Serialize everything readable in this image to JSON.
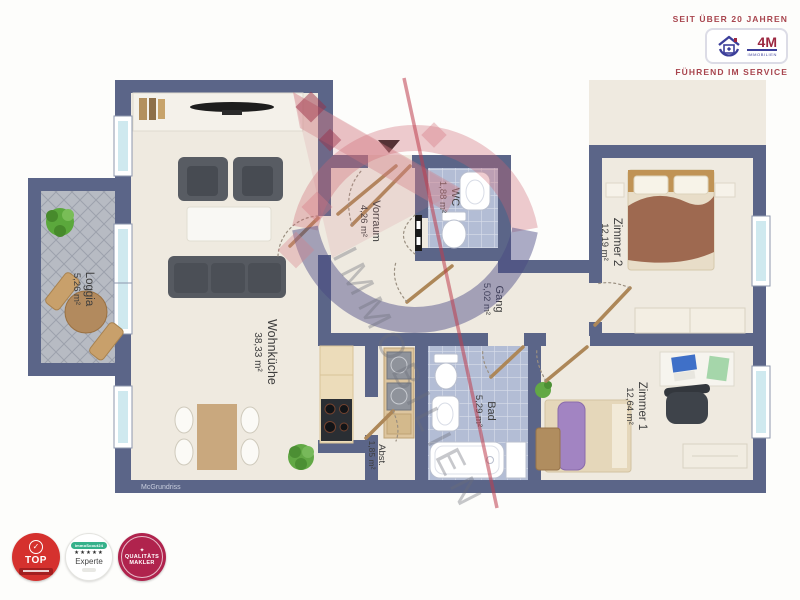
{
  "header": {
    "tagline_top": "SEIT ÜBER 20 JAHREN",
    "tagline_bottom": "FÜHREND IM SERVICE",
    "logo_text": "4M",
    "logo_subtext": "IMMOBILIEN"
  },
  "watermark": {
    "text": "IMMOBILIEN"
  },
  "credit": "McGrundriss",
  "rooms": [
    {
      "name": "Loggia",
      "area": "5,26 m²"
    },
    {
      "name": "Wohnküche",
      "area": "38,33 m²"
    },
    {
      "name": "Vorraum",
      "area": "4,26 m²"
    },
    {
      "name": "WC",
      "area": "1,88 m²"
    },
    {
      "name": "Gang",
      "area": "5,02 m²"
    },
    {
      "name": "Zimmer 2",
      "area": "12,19 m²"
    },
    {
      "name": "Zimmer 1",
      "area": "12,64 m²"
    },
    {
      "name": "Bad",
      "area": "5,29 m²"
    },
    {
      "name": "Abst.",
      "area": "1,85 m²"
    }
  ],
  "badges": {
    "top": {
      "label": "TOP"
    },
    "experte": {
      "brand": "ImmoScout24",
      "stars": "★★★★★",
      "label": "Experte"
    },
    "makler": {
      "line1": "QUALITÄTS",
      "line2": "MAKLER"
    }
  },
  "colors": {
    "wall": "#5b6588",
    "floor": "#efeae0",
    "tile_blue": "#b3bdd5",
    "tile_gray": "#b7bbc3",
    "accent_red": "#a8454e",
    "logo_blue": "#3c3f9a",
    "badge_red": "#d5312e",
    "badge_crimson": "#b0234d"
  }
}
